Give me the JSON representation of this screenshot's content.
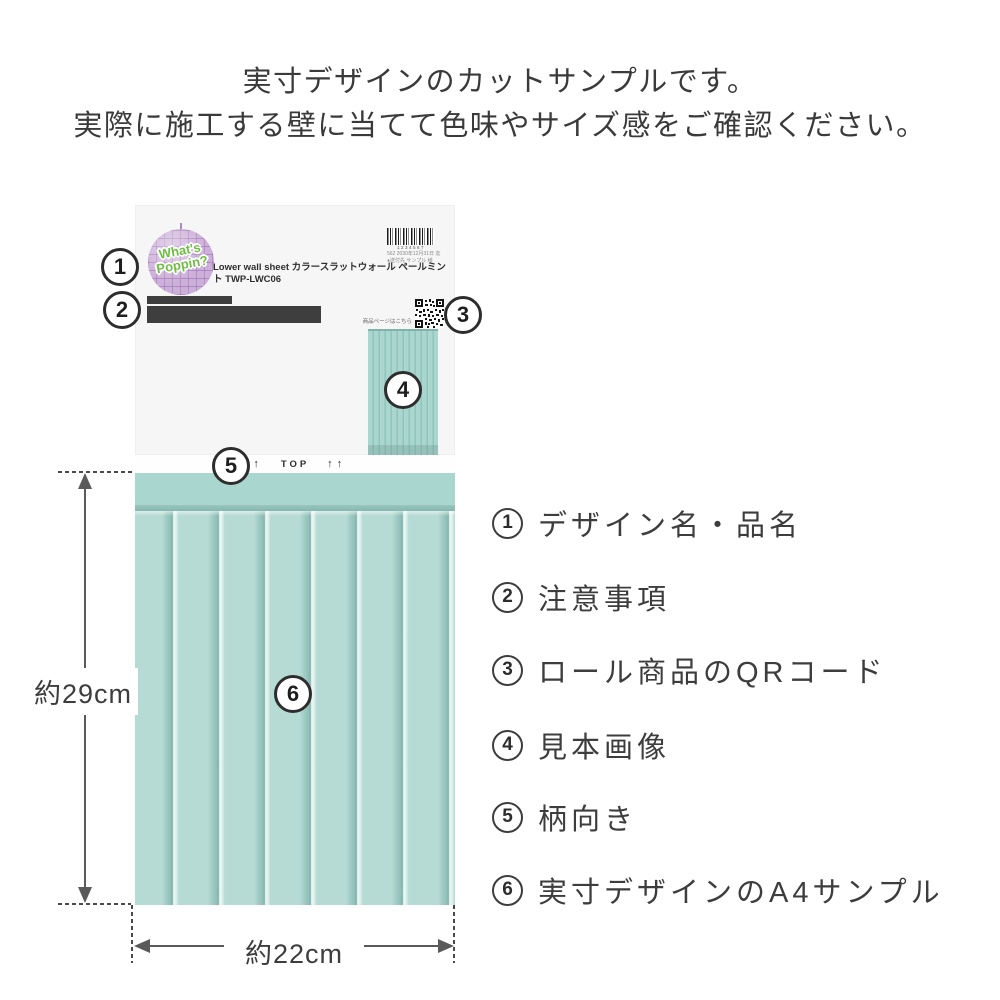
{
  "header": {
    "line1": "実寸デザインのカットサンプルです。",
    "line2": "実際に施工する壁に当てて色味やサイズ感をご確認ください。"
  },
  "package": {
    "logo": {
      "line1": "What's",
      "line2": "Poppin?"
    },
    "title": "Lower wall sheet カラースラットウォール ペールミント TWP-LWC06",
    "barcode": {
      "digits": "1234567",
      "note_line1": "562 2030年12月31日 迄",
      "note_line2": "●送付先 サンプル 様"
    },
    "qr_caption": "商品ページはこちら",
    "orientation": {
      "arrows_left": "↑↑",
      "label": "TOP",
      "arrows_right": "↑↑"
    }
  },
  "markers": [
    "1",
    "2",
    "3",
    "4",
    "5",
    "6"
  ],
  "legend": {
    "items": [
      {
        "num": "1",
        "label": "デザイン名・品名"
      },
      {
        "num": "2",
        "label": "注意事項"
      },
      {
        "num": "3",
        "label": "ロール商品のQRコード"
      },
      {
        "num": "4",
        "label": "見本画像"
      },
      {
        "num": "5",
        "label": "柄向き"
      },
      {
        "num": "6",
        "label": "実寸デザインのA4サンプル"
      }
    ]
  },
  "dimensions": {
    "height_label": "約29cm",
    "width_label": "約22cm"
  },
  "colors": {
    "mint_panel": "#b6dbd5",
    "mint_groove": "#8dbeb7",
    "mint_band": "#a9d6cf",
    "logo_green": "#6fbe44",
    "logo_lavender": "#cdb0d9",
    "redaction_gray": "#3e3e3e"
  }
}
